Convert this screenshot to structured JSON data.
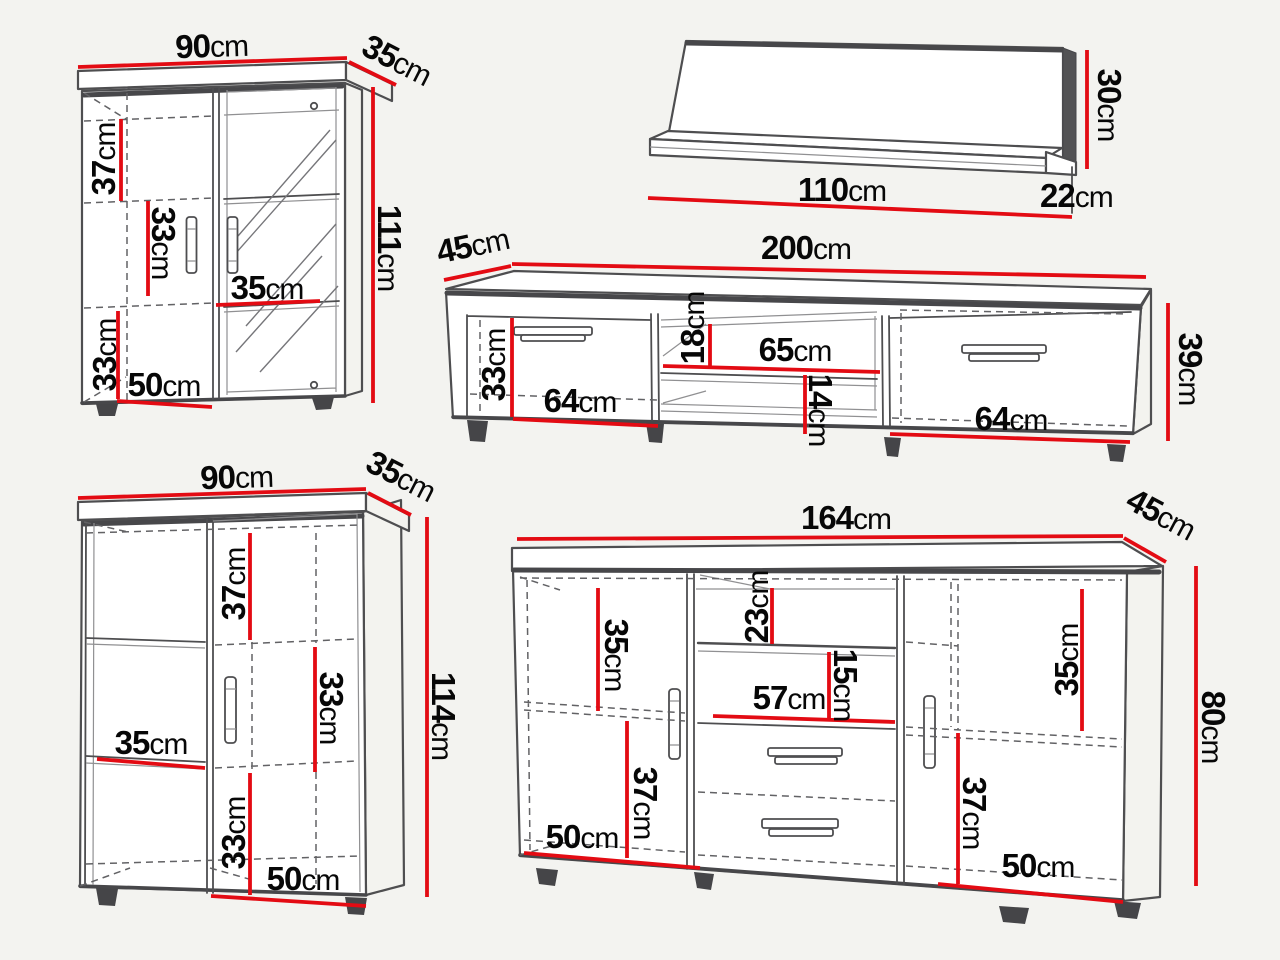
{
  "title": "furniture-set-dimensions-diagram",
  "colors": {
    "background": "#f3f3f0",
    "outline": "#4e4e50",
    "dashed": "#626265",
    "dimension_red": "#e30b13",
    "label_text": "#070707"
  },
  "furniture": [
    {
      "id": "display-cabinet",
      "overall": {
        "width": {
          "v": "90",
          "u": "cm"
        },
        "depth": {
          "v": "35",
          "u": "cm"
        },
        "height": {
          "v": "111",
          "u": "cm"
        }
      },
      "inner": {
        "top_section": {
          "v": "37",
          "u": "cm"
        },
        "mid_section": {
          "v": "33",
          "u": "cm"
        },
        "shelf_width": {
          "v": "35",
          "u": "cm"
        },
        "bottom_section": {
          "v": "33",
          "u": "cm"
        },
        "base_width": {
          "v": "50",
          "u": "cm"
        }
      }
    },
    {
      "id": "wall-shelf",
      "overall": {
        "width": {
          "v": "110",
          "u": "cm"
        },
        "depth": {
          "v": "22",
          "u": "cm"
        },
        "height": {
          "v": "30",
          "u": "cm"
        }
      }
    },
    {
      "id": "tv-stand",
      "overall": {
        "width": {
          "v": "200",
          "u": "cm"
        },
        "depth": {
          "v": "45",
          "u": "cm"
        },
        "height": {
          "v": "39",
          "u": "cm"
        }
      },
      "inner": {
        "left_height": {
          "v": "33",
          "u": "cm"
        },
        "left_width": {
          "v": "64",
          "u": "cm"
        },
        "niche_height": {
          "v": "18",
          "u": "cm"
        },
        "niche_width": {
          "v": "65",
          "u": "cm"
        },
        "niche_bottom": {
          "v": "14",
          "u": "cm"
        },
        "right_width": {
          "v": "64",
          "u": "cm"
        }
      }
    },
    {
      "id": "highboard",
      "overall": {
        "width": {
          "v": "90",
          "u": "cm"
        },
        "depth": {
          "v": "35",
          "u": "cm"
        },
        "height": {
          "v": "114",
          "u": "cm"
        }
      },
      "inner": {
        "top_section": {
          "v": "37",
          "u": "cm"
        },
        "mid_section": {
          "v": "33",
          "u": "cm"
        },
        "shelf_width": {
          "v": "35",
          "u": "cm"
        },
        "bottom_section": {
          "v": "33",
          "u": "cm"
        },
        "base_width": {
          "v": "50",
          "u": "cm"
        }
      }
    },
    {
      "id": "sideboard",
      "overall": {
        "width": {
          "v": "164",
          "u": "cm"
        },
        "depth": {
          "v": "45",
          "u": "cm"
        },
        "height": {
          "v": "80",
          "u": "cm"
        }
      },
      "inner": {
        "left_top": {
          "v": "35",
          "u": "cm"
        },
        "niche_top": {
          "v": "23",
          "u": "cm"
        },
        "niche_mid": {
          "v": "15",
          "u": "cm"
        },
        "niche_width": {
          "v": "57",
          "u": "cm"
        },
        "left_bottom": {
          "v": "37",
          "u": "cm"
        },
        "left_base": {
          "v": "50",
          "u": "cm"
        },
        "right_top": {
          "v": "35",
          "u": "cm"
        },
        "right_bottom": {
          "v": "37",
          "u": "cm"
        },
        "right_base": {
          "v": "50",
          "u": "cm"
        }
      }
    }
  ]
}
